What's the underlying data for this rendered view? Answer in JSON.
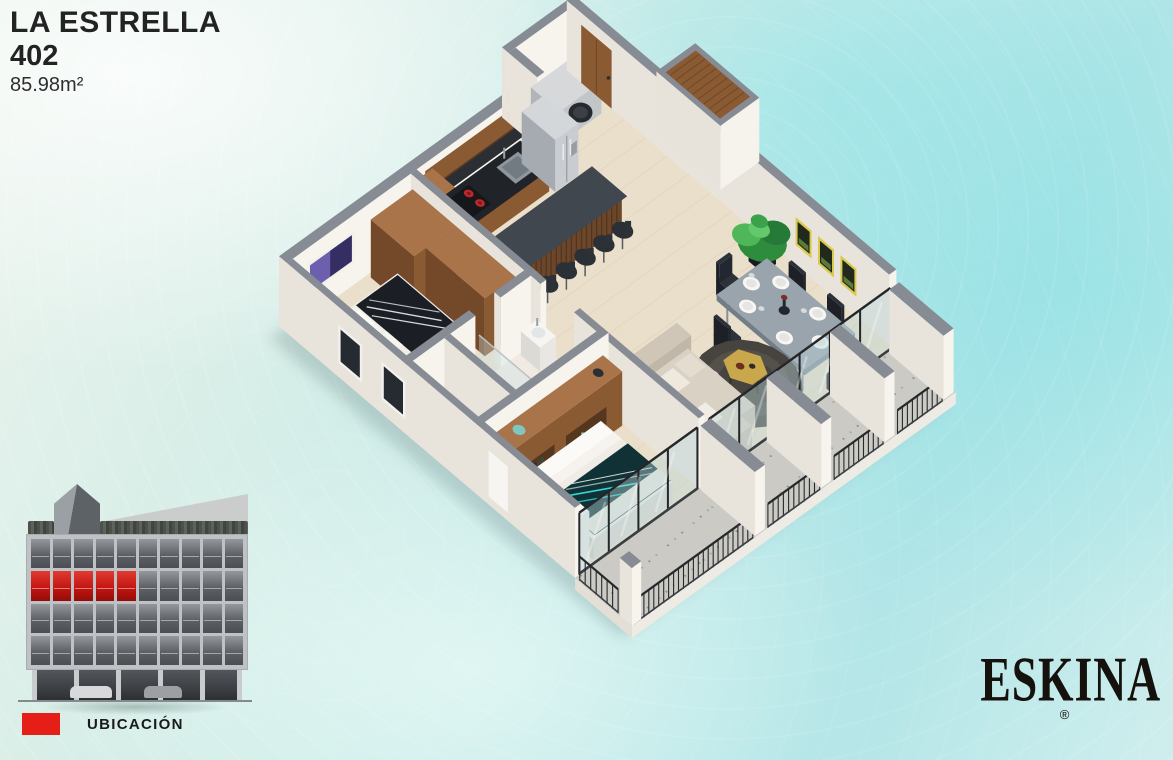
{
  "header": {
    "project_name": "LA ESTRELLA",
    "unit_number": "402",
    "unit_area": "85.98m²"
  },
  "legend": {
    "label": "UBICACIÓN",
    "swatch_color": "#e51e17"
  },
  "brand": {
    "logo_text": "ESKINA",
    "registered_mark": "®",
    "tagline": "URBAN CORNER LIVING"
  },
  "palette": {
    "water": "#c3eae9",
    "wall_top": "#878c94",
    "wall_light": "#f7f4ee",
    "wall_shade": "#e9e4db",
    "wood": "#8a5a33",
    "wood_top": "#a9744a",
    "floor_wood": "#eadfca",
    "terrace_floor": "#cbcac4",
    "island_top": "#3a4047",
    "accent_red": "#e51e17",
    "blanket_teal": "#103237",
    "glass": "#b9d9da"
  },
  "elevation": {
    "window_rows": 4,
    "window_cols": 10,
    "highlighted_row": 1,
    "highlighted_cols": [
      0,
      1,
      2,
      3,
      4
    ],
    "highlight_color": "#d6201d"
  }
}
